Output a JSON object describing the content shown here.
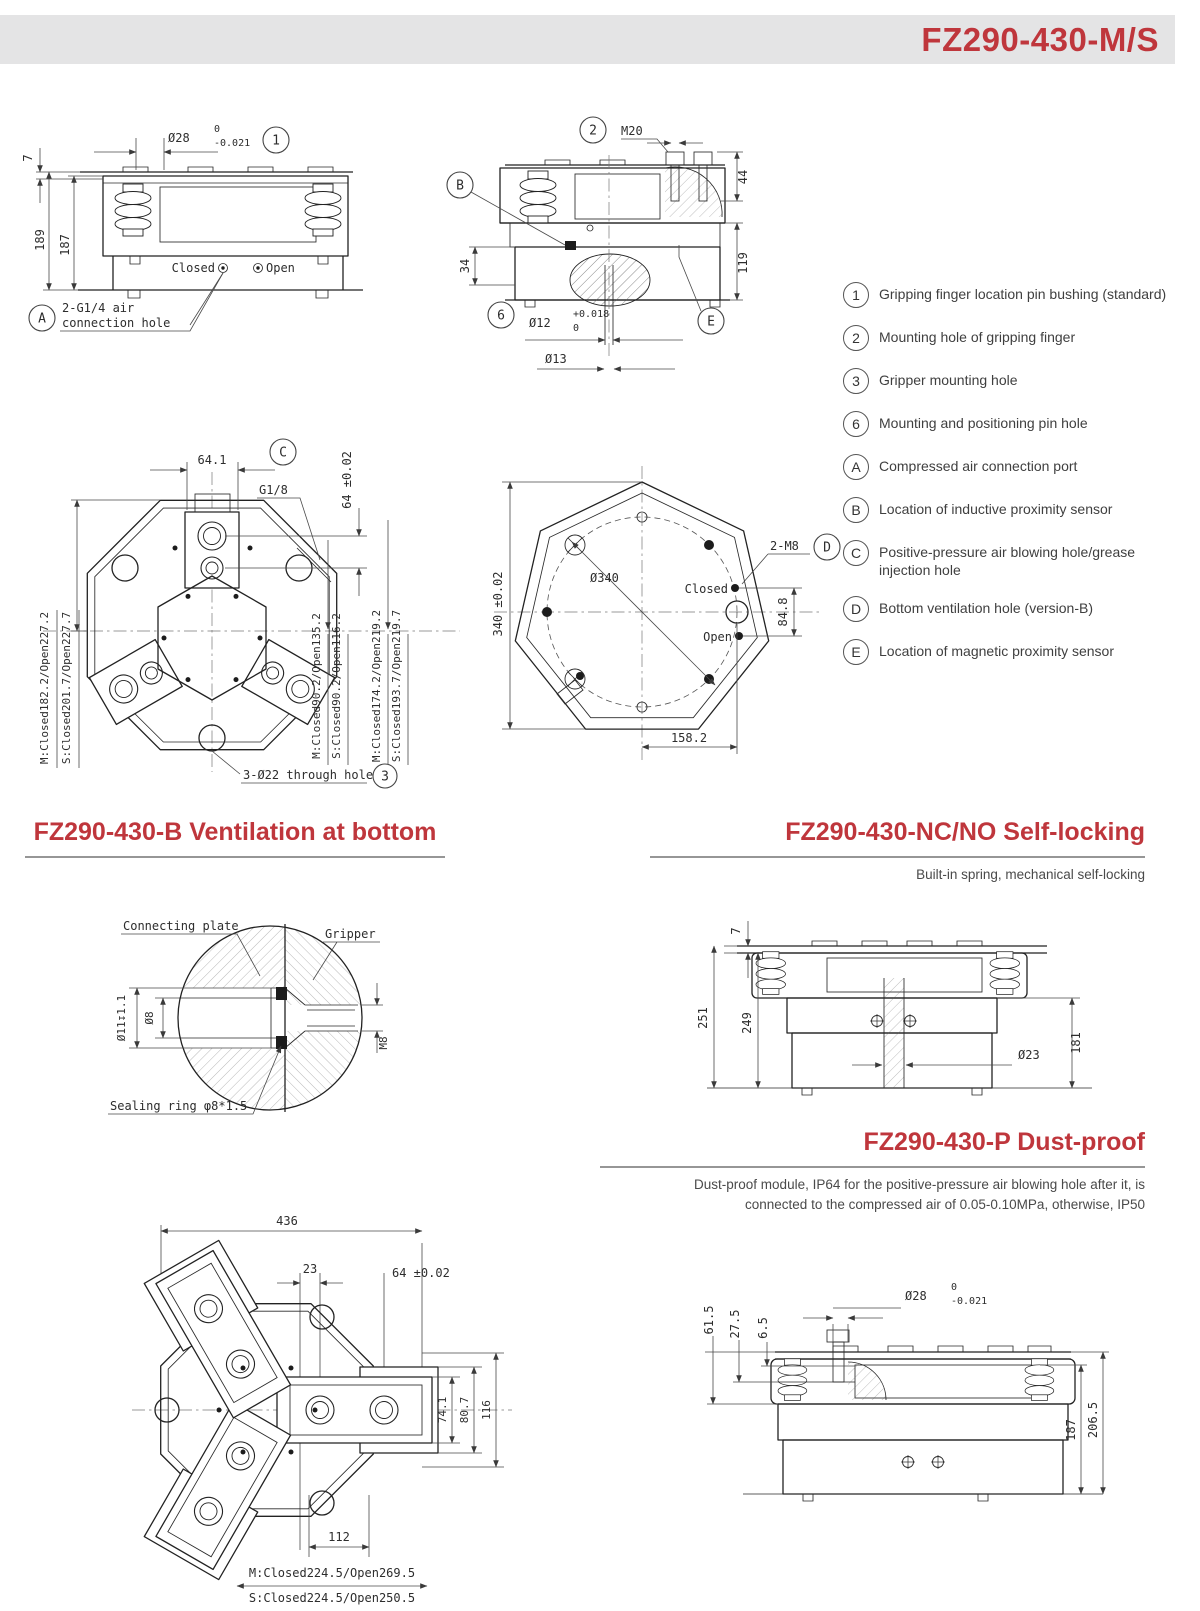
{
  "header": {
    "title": "FZ290-430-M/S"
  },
  "legend": {
    "items": [
      {
        "symbol": "1",
        "text": "Gripping finger location pin bushing (standard)"
      },
      {
        "symbol": "2",
        "text": "Mounting hole of gripping finger"
      },
      {
        "symbol": "3",
        "text": "Gripper mounting hole"
      },
      {
        "symbol": "6",
        "text": "Mounting and positioning pin hole"
      },
      {
        "symbol": "A",
        "text": "Compressed air connection port"
      },
      {
        "symbol": "B",
        "text": "Location of inductive proximity sensor"
      },
      {
        "symbol": "C",
        "text": "Positive-pressure air blowing hole/grease injection hole"
      },
      {
        "symbol": "D",
        "text": "Bottom ventilation hole (version-B)"
      },
      {
        "symbol": "E",
        "text": "Location of magnetic proximity sensor"
      }
    ]
  },
  "front_view": {
    "dim_7": "7",
    "dim_189": "189",
    "dim_187": "187",
    "dia": "Ø28",
    "tol_up": "0",
    "tol_dn": "-0.021",
    "balloon": "1",
    "closed": "Closed",
    "open": "Open",
    "air_line1": "2-G1/4 air",
    "air_line2": "connection hole",
    "balloon_a": "A"
  },
  "section_view": {
    "balloon_2": "2",
    "thread": "M20",
    "dim_44": "44",
    "dim_119": "119",
    "dim_34": "34",
    "balloon_b": "B",
    "balloon_6": "6",
    "dia12": "Ø12",
    "tol12_up": "+0.018",
    "tol12_dn": "0",
    "dia13": "Ø13",
    "balloon_e": "E"
  },
  "top_view": {
    "dim_641": "64.1",
    "balloon_c": "C",
    "thread": "G1/8",
    "dim_64": "64 ±0.02",
    "left_m": "M:Closed182.2/Open227.2",
    "left_s": "S:Closed201.7/Open227.7",
    "right1_m": "M:Closed90.2/Open135.2",
    "right1_s": "S:Closed90.2/Open116.2",
    "right2_m": "M:Closed174.2/Open219.2",
    "right2_s": "S:Closed193.7/Open219.7",
    "hole_label": "3-Ø22 through hole",
    "balloon_3": "3"
  },
  "bottom_view": {
    "dim_340": "340 ±0.02",
    "dia_340": "Ø340",
    "label_2m8": "2-M8",
    "balloon_d": "D",
    "closed": "Closed",
    "open": "Open",
    "dim_848": "84.8",
    "dim_1582": "158.2"
  },
  "section_b": {
    "title": "FZ290-430-B Ventilation at bottom"
  },
  "vent_detail": {
    "connecting_plate": "Connecting plate",
    "gripper": "Gripper",
    "dim_d11": "Ø11↧1.1",
    "dim_d8": "Ø8",
    "dim_m8": "M8",
    "sealing": "Sealing ring φ8*1.5"
  },
  "section_nc": {
    "title": "FZ290-430-NC/NO Self-locking",
    "subtitle": "Built-in spring, mechanical self-locking"
  },
  "nc_view": {
    "dim_7": "7",
    "dim_251": "251",
    "dim_249": "249",
    "dim_181": "181",
    "dia_23": "Ø23"
  },
  "section_p": {
    "title": "FZ290-430-P Dust-proof",
    "subtitle_line1": "Dust-proof module, IP64 for the positive-pressure air blowing hole after it, is",
    "subtitle_line2": "connected to the compressed air of 0.05-0.10MPa, otherwise, IP50"
  },
  "p_top_view": {
    "dim_436": "436",
    "dim_23": "23",
    "dim_64": "64 ±0.02",
    "dim_741": "74.1",
    "dim_807": "80.7",
    "dim_116": "116",
    "dim_112": "112",
    "label_m": "M:Closed224.5/Open269.5",
    "label_s": "S:Closed224.5/Open250.5"
  },
  "p_side_view": {
    "dim_615": "61.5",
    "dim_275": "27.5",
    "dim_65": "6.5",
    "dia": "Ø28",
    "tol_up": "0",
    "tol_dn": "-0.021",
    "dim_187": "187",
    "dim_2065": "206.5"
  }
}
